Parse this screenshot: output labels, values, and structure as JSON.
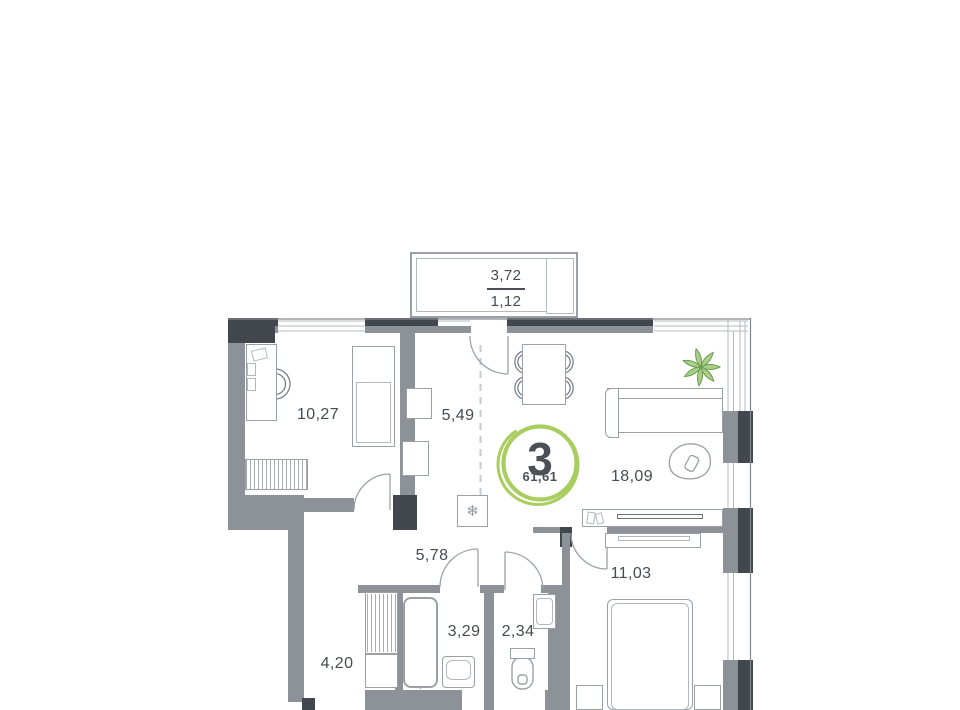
{
  "plan": {
    "badge": {
      "rooms_count": "3",
      "total_area": "61,61"
    },
    "balcony": {
      "area": "3,72",
      "area_reduced": "1,12"
    },
    "rooms": {
      "study": {
        "area": "10,27"
      },
      "kitchen": {
        "area": "5,49"
      },
      "living": {
        "area": "18,09"
      },
      "hallway": {
        "area": "5,78"
      },
      "corridor": {
        "area": "4,20"
      },
      "bathroom": {
        "area": "3,29"
      },
      "wc": {
        "area": "2,34"
      },
      "bedroom": {
        "area": "11,03"
      }
    },
    "icons": {
      "snowflake": "❄"
    },
    "colors": {
      "wall_dark": "#42474e",
      "wall_gray": "#8d9298",
      "furniture_line": "#9aa0a6",
      "accent_green": "#a9cd5f",
      "plant_green": "#a8cf86",
      "text": "#464b51"
    }
  }
}
